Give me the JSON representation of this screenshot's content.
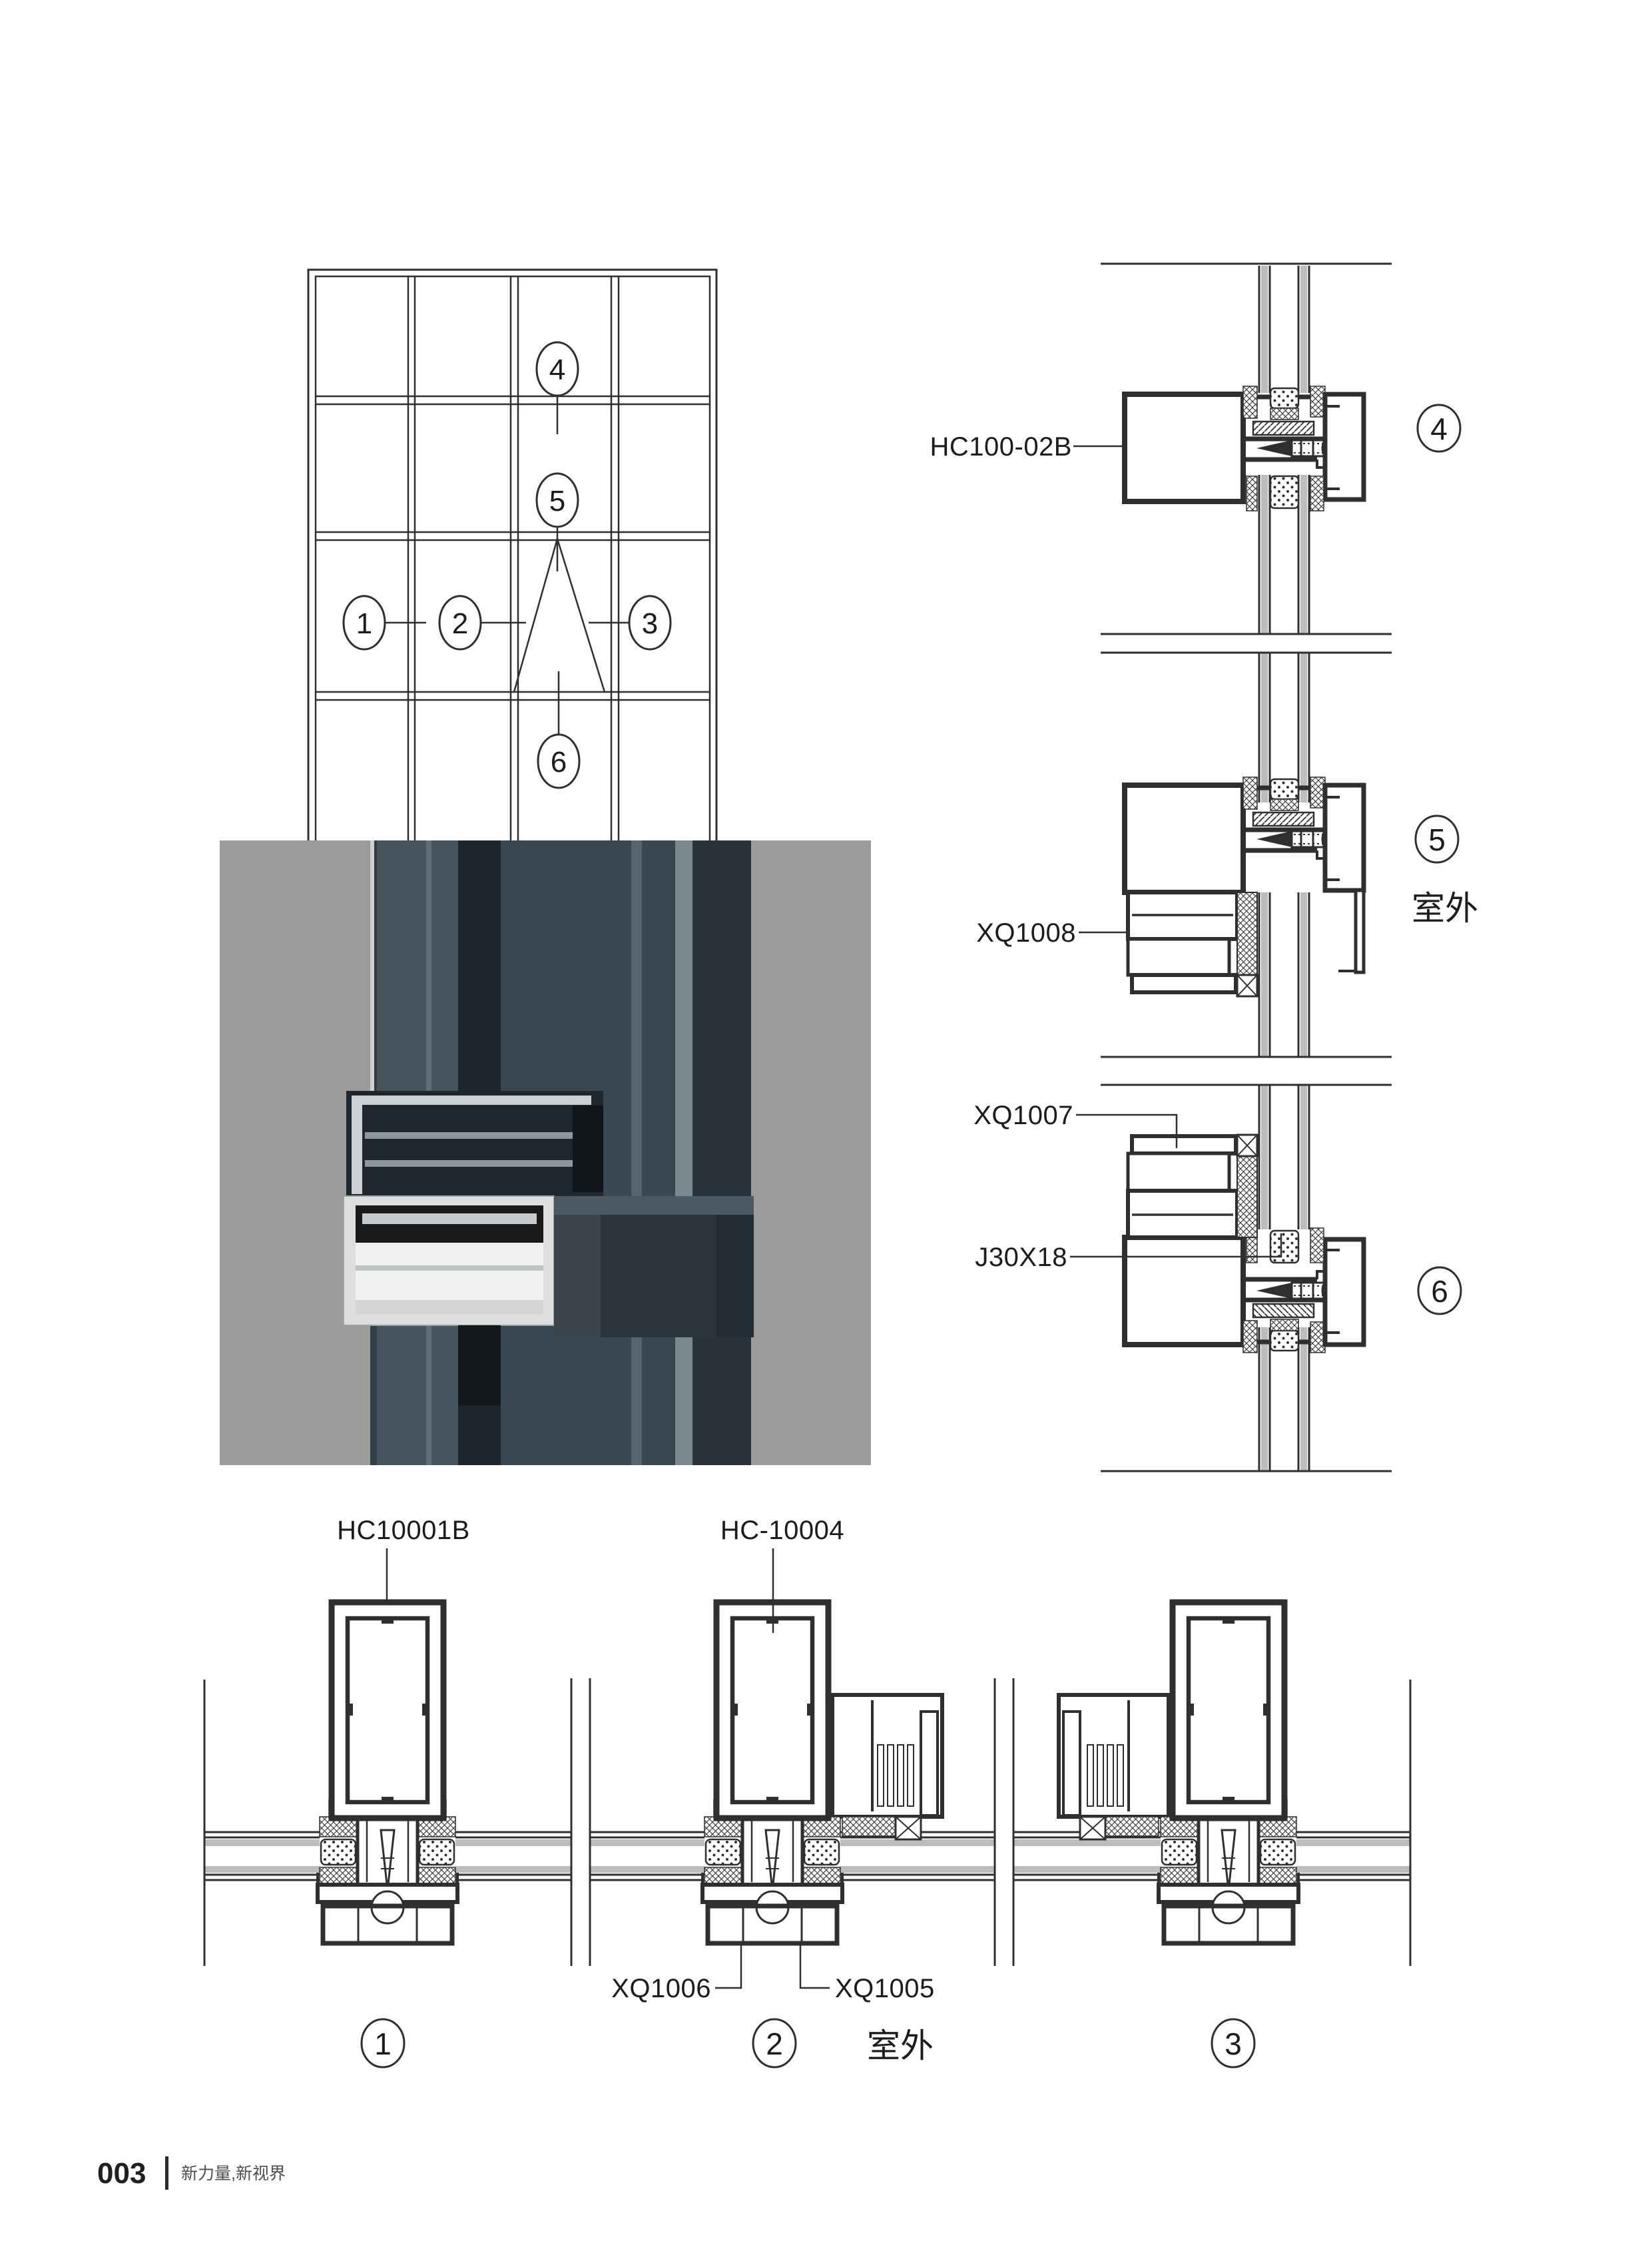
{
  "footer": {
    "page_number": "003",
    "slogan": "新力量,新视界"
  },
  "elevation": {
    "callout_1": "1",
    "callout_2": "2",
    "callout_3": "3",
    "callout_4": "4",
    "callout_5": "5",
    "callout_6": "6"
  },
  "vertical_sections": {
    "mullion_label": "HC100-02B",
    "frame_label": "XQ1008",
    "sash_label": "XQ1007",
    "corner_label": "J30X18",
    "outdoor_label": "室外",
    "callout_4": "4",
    "callout_5": "5",
    "callout_6": "6"
  },
  "horizontal_sections": {
    "mullion_label_1": "HC10001B",
    "mullion_label_2": "HC-10004",
    "cap_label": "XQ1006",
    "plate_label": "XQ1005",
    "outdoor_label": "室外",
    "callout_1": "1",
    "callout_2": "2",
    "callout_3": "3"
  }
}
